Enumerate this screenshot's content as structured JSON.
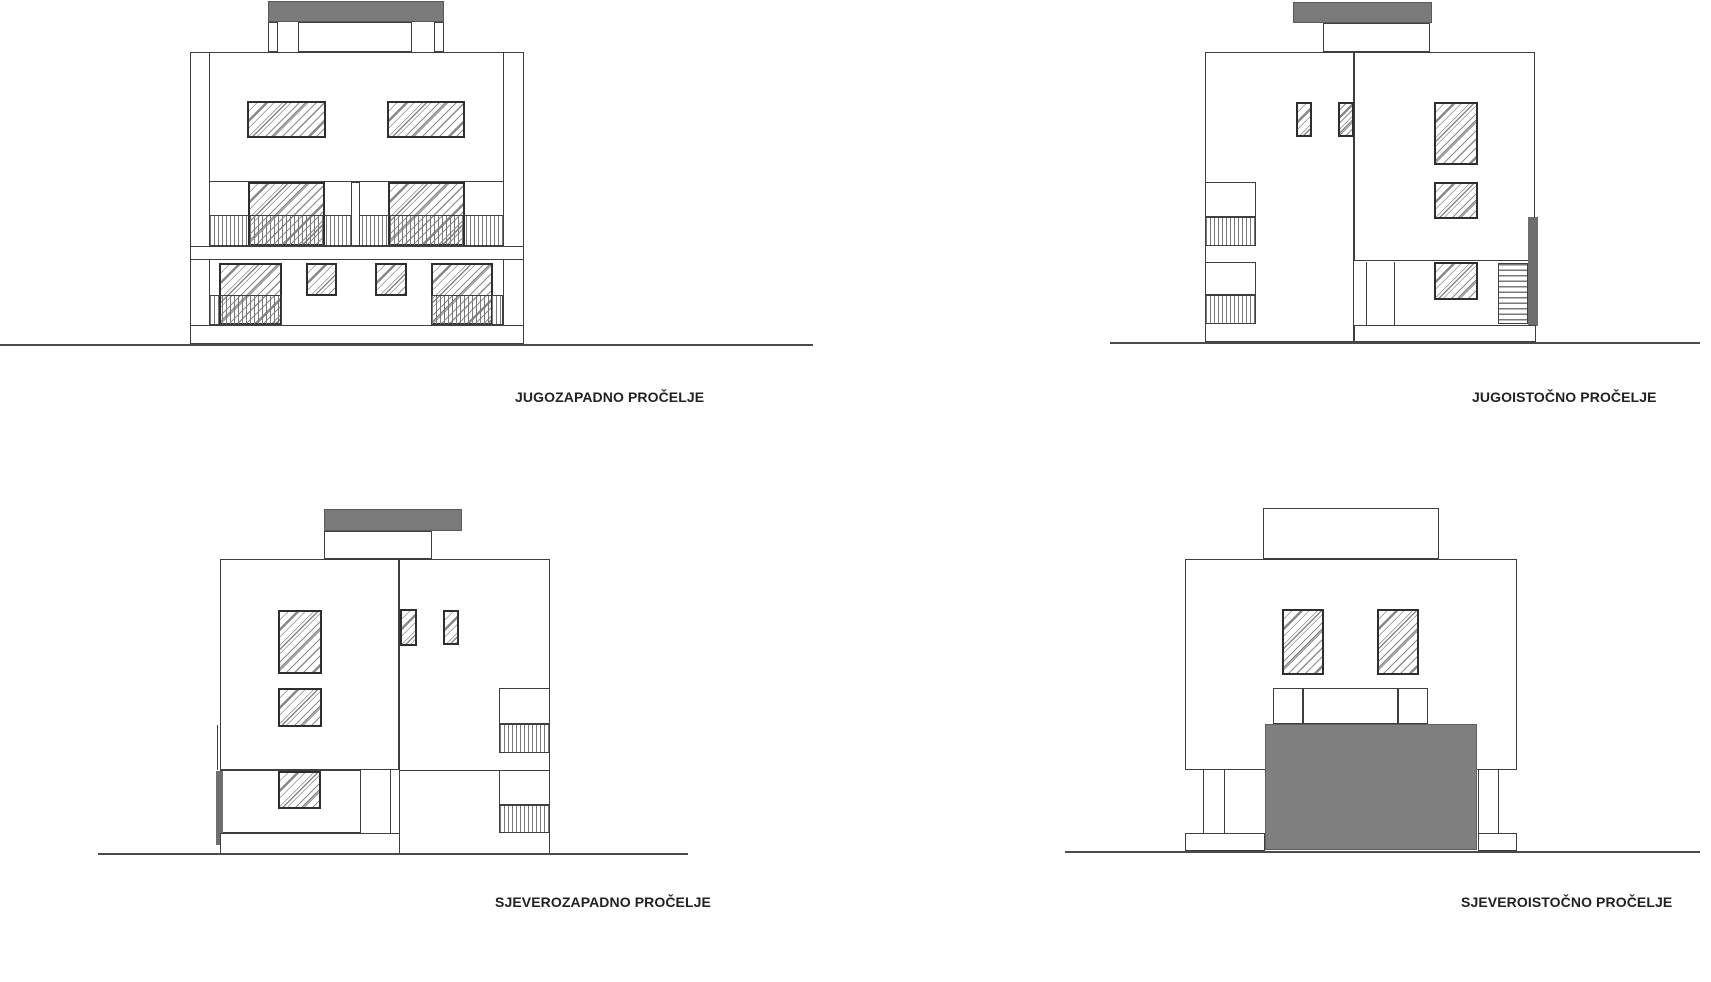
{
  "sheet": {
    "background": "#ffffff",
    "drawing_type": "building elevations"
  },
  "facades": [
    {
      "id": "southwest",
      "label": "JUGOZAPADNO PROČELJE"
    },
    {
      "id": "southeast",
      "label": "JUGOISTOČNO PROČELJE"
    },
    {
      "id": "northwest",
      "label": "SJEVEROZAPADNO PROČELJE"
    },
    {
      "id": "northeast",
      "label": "SJEVEROISTOČNO PROČELJE"
    }
  ],
  "colors": {
    "line": "#3f3f3f",
    "window_frame": "#2e2e2e",
    "slab_gray": "#7a7a7a",
    "garage_gray": "#7f7f7f",
    "edge_gray": "#6e6e6e",
    "hatch": "#8c8c8c",
    "stripe": "#787878",
    "label_text": "#222222",
    "ground_line": "#4a4a4a"
  }
}
